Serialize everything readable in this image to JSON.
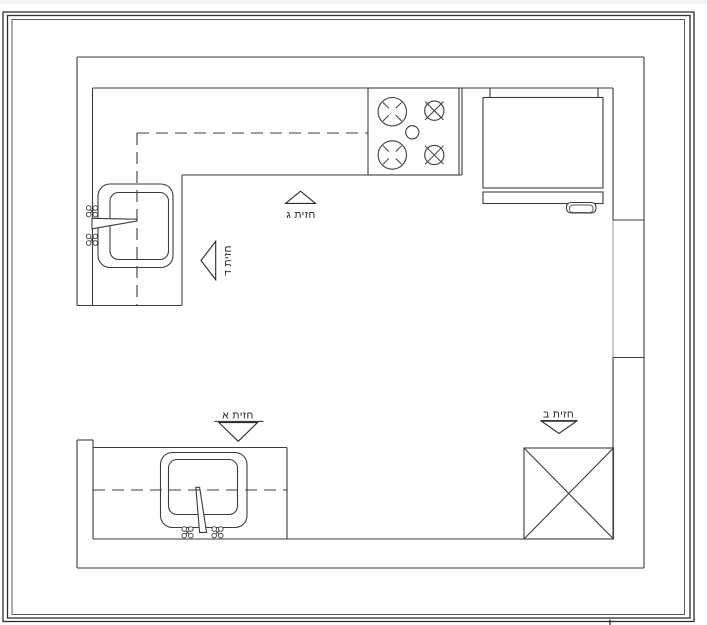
{
  "drawing": {
    "title": "Kitchen floor plan",
    "labels": {
      "elevation_a": "חזית א",
      "elevation_b": "חזית ב",
      "elevation_c": "חזית ג",
      "elevation_d": "חזית ד"
    },
    "colors": {
      "line": "#3c3c3c",
      "frame": "#2e2e2e",
      "text": "#1f1f1f",
      "background": "#ffffff"
    }
  }
}
